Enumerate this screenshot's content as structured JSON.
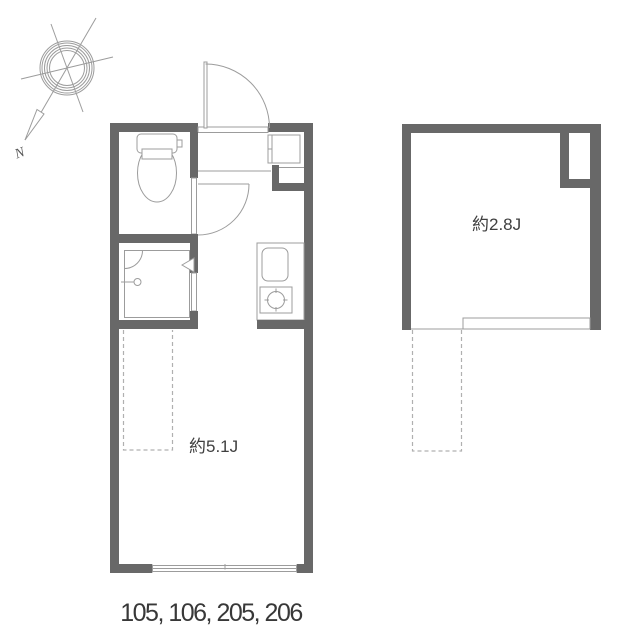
{
  "colors": {
    "wall": "#686868",
    "line": "#9c9c9c",
    "dash": "#b0b0b0",
    "text": "#3f3f3f",
    "footer": "#383838"
  },
  "compass": {
    "north_label": "N"
  },
  "main_plan": {
    "room_label": "約5.1J",
    "fixtures": [
      "toilet",
      "shower",
      "kitchen-sink",
      "single-burner-stove",
      "entrance-door",
      "interior-door",
      "sliding-window",
      "loft-overhead-dashed-area"
    ]
  },
  "loft_plan": {
    "room_label": "約2.8J",
    "features": [
      "void-corner",
      "railing-edge",
      "ladder-dashed-area"
    ]
  },
  "footer": {
    "unit_numbers": "105, 106, 205, 206"
  }
}
